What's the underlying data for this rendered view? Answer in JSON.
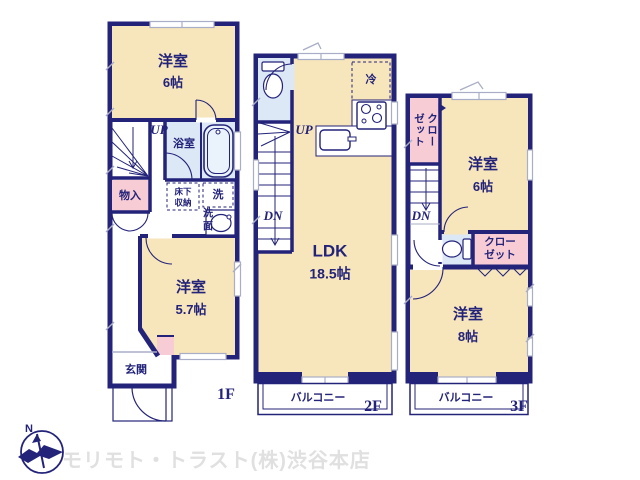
{
  "colors": {
    "wall": "#23237a",
    "room_cream": "#f7e5bb",
    "closet_pink": "#f7ccd4",
    "wet_blue": "#dce8f6",
    "window_gray": "#a9aec6",
    "text_navy": "#23237a",
    "watermark_gray": "#e0e0e0"
  },
  "floor1": {
    "label": "1F",
    "bedroom6": {
      "name": "洋室",
      "size": "6帖"
    },
    "bath_label": "浴室",
    "storage_label": "物入",
    "underfloor_label": "床下収納",
    "laundry_label": "洗",
    "basin_label": "洗面",
    "bedroom57": {
      "name": "洋室",
      "size": "5.7帖"
    },
    "entrance_label": "玄関",
    "up_label": "UP"
  },
  "floor2": {
    "label": "2F",
    "ldk": {
      "name": "LDK",
      "size": "18.5帖"
    },
    "fridge_label": "冷",
    "balcony_label": "バルコニー",
    "up_label": "UP",
    "down_label": "DN"
  },
  "floor3": {
    "label": "3F",
    "bedroom6": {
      "name": "洋室",
      "size": "6帖"
    },
    "closet_left_label": "クローゼット",
    "closet_right_label": "クローゼット",
    "bedroom8": {
      "name": "洋室",
      "size": "8帖"
    },
    "balcony_label": "バルコニー",
    "down_label": "DN"
  },
  "footer": {
    "compass_label": "N",
    "company_watermark": "モリモト・トラスト(株)渋谷本店"
  }
}
